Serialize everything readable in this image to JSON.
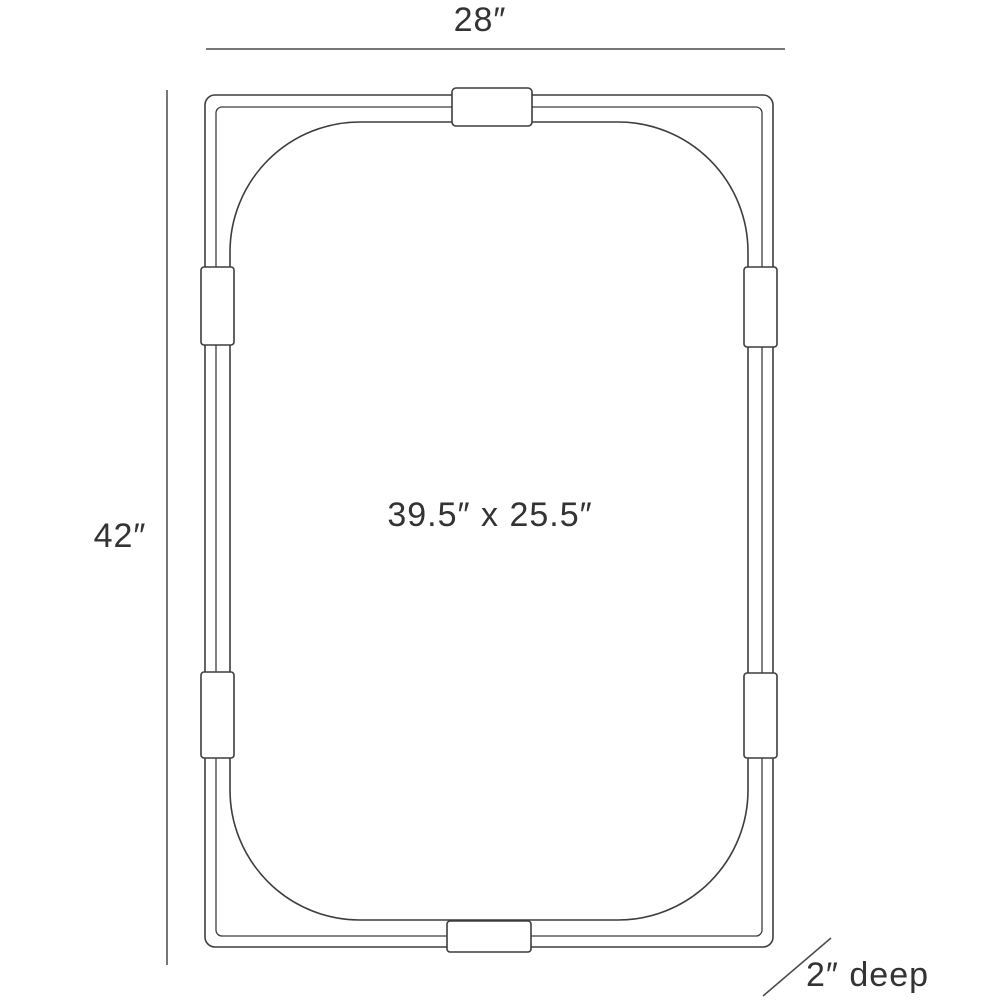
{
  "diagram": {
    "kind": "mirror-dimension-drawing",
    "background_color": "#ffffff",
    "line_color": "#3d3d3d",
    "text_color": "#333333",
    "labels": {
      "overall_width": "28″",
      "overall_height": "42″",
      "inner_dimensions": "39.5″ x 25.5″",
      "depth": "2″ deep"
    },
    "measurements": {
      "overall_width_in": 28,
      "overall_height_in": 42,
      "inner_height_in": 39.5,
      "inner_width_in": 25.5,
      "depth_in": 2
    }
  }
}
